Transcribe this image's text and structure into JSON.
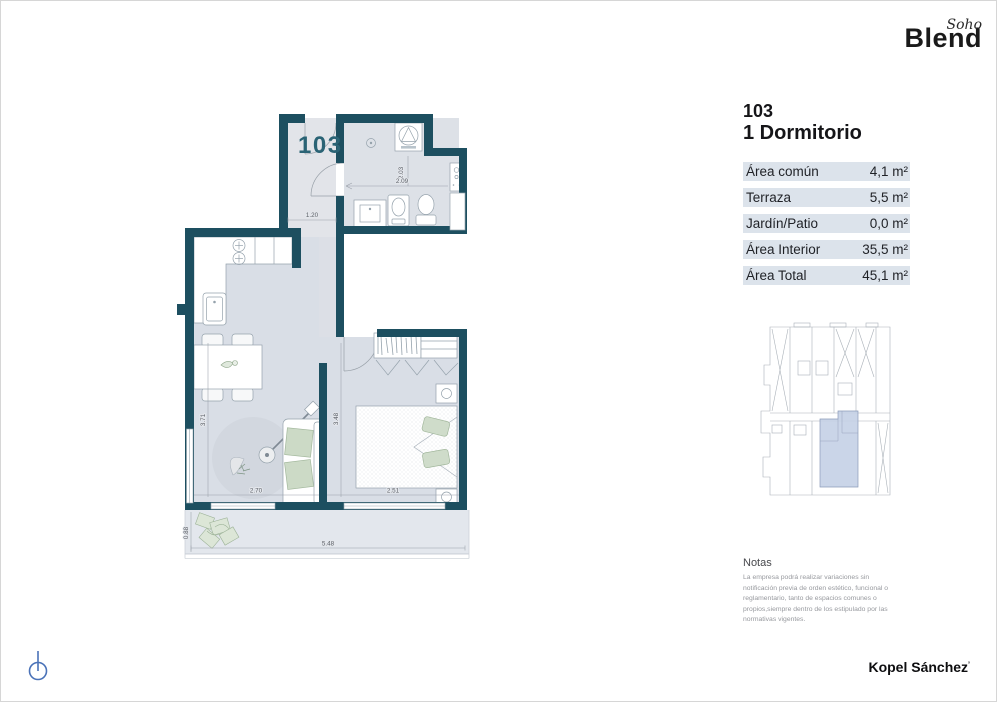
{
  "logo": {
    "script": "Soho",
    "brand": "Blend"
  },
  "unit": {
    "number": "103",
    "name": "1 Dormitorio"
  },
  "area_table": {
    "rows": [
      {
        "label": "Área común",
        "value": "4,1 m²"
      },
      {
        "label": "Terraza",
        "value": "5,5 m²"
      },
      {
        "label": "Jardín/Patio",
        "value": "0,0 m²"
      },
      {
        "label": "Área Interior",
        "value": "35,5 m²"
      },
      {
        "label": "Área Total",
        "value": "45,1 m²"
      }
    ]
  },
  "plan": {
    "label": "103",
    "dims": {
      "hall": "1.20",
      "bath_depth": "2.03",
      "bath_width": "2.09",
      "living_depth": "3.71",
      "living_width": "2.70",
      "bedroom_depth": "3.48",
      "bedroom_width": "2.51",
      "terrace_depth": "0.88",
      "terrace_width": "5.48"
    }
  },
  "notes": {
    "title": "Notas",
    "body": "La empresa podrá realizar variaciones sin notificación previa de orden estético, funcional o reglamentario, tanto de espacios comunes o propios,siempre dentro de los estipulado por las normativas vigentes."
  },
  "footer": {
    "studio": "Kopel Sánchez",
    "mark": "’"
  },
  "colors": {
    "wall": "#1d4f60",
    "floor": "#d9dee6",
    "plan_accent": "#2a6375",
    "table_row_bg": "#dce3eb",
    "keyplan_highlight": "#c4d0e5",
    "north_icon": "#4a72b8"
  }
}
